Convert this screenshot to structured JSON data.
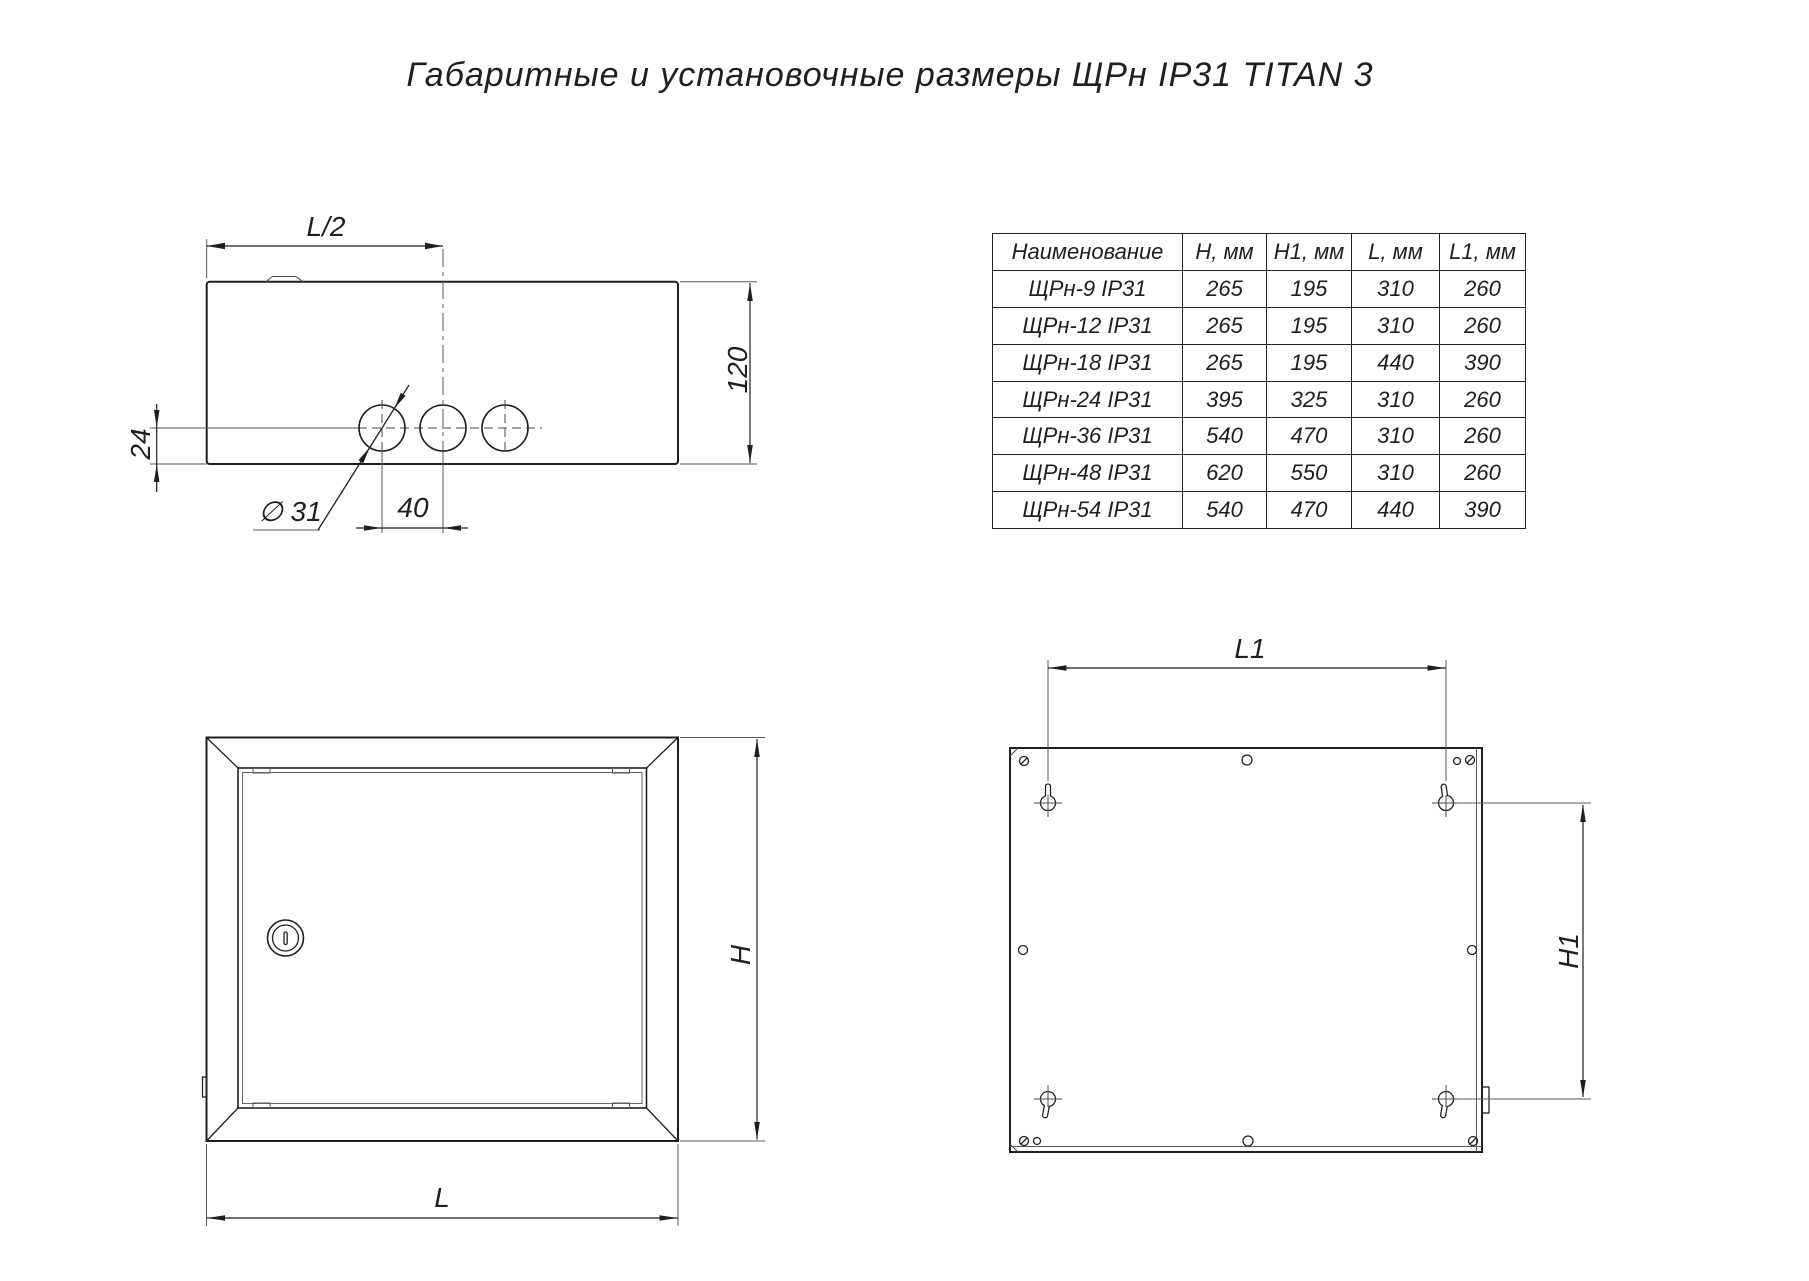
{
  "title": "Габаритные и установочные размеры ЩРн IP31 TITAN 3",
  "table": {
    "headers": [
      "Наименование",
      "H, мм",
      "H1, мм",
      "L, мм",
      "L1, мм"
    ],
    "rows": [
      {
        "name": "ЩРн-9 IP31",
        "h": "265",
        "h1": "195",
        "l": "310",
        "l1": "260"
      },
      {
        "name": "ЩРн-12 IP31",
        "h": "265",
        "h1": "195",
        "l": "310",
        "l1": "260"
      },
      {
        "name": "ЩРн-18 IP31",
        "h": "265",
        "h1": "195",
        "l": "440",
        "l1": "390"
      },
      {
        "name": "ЩРн-24 IP31",
        "h": "395",
        "h1": "325",
        "l": "310",
        "l1": "260"
      },
      {
        "name": "ЩРн-36 IP31",
        "h": "540",
        "h1": "470",
        "l": "310",
        "l1": "260"
      },
      {
        "name": "ЩРн-48 IP31",
        "h": "620",
        "h1": "550",
        "l": "310",
        "l1": "260"
      },
      {
        "name": "ЩРн-54 IP31",
        "h": "540",
        "h1": "470",
        "l": "440",
        "l1": "390"
      }
    ]
  },
  "top_view": {
    "half_length_label": "L/2",
    "depth_label": "120",
    "hole_offset_label": "24",
    "hole_diameter_label": "∅ 31",
    "hole_spacing_label": "40"
  },
  "front_view": {
    "height_label": "H",
    "length_label": "L"
  },
  "back_view": {
    "mount_width_label": "L1",
    "mount_height_label": "H1"
  },
  "colors": {
    "line_main": "#1f1f1f",
    "line_thin": "#5a5a5a",
    "background": "#ffffff"
  }
}
